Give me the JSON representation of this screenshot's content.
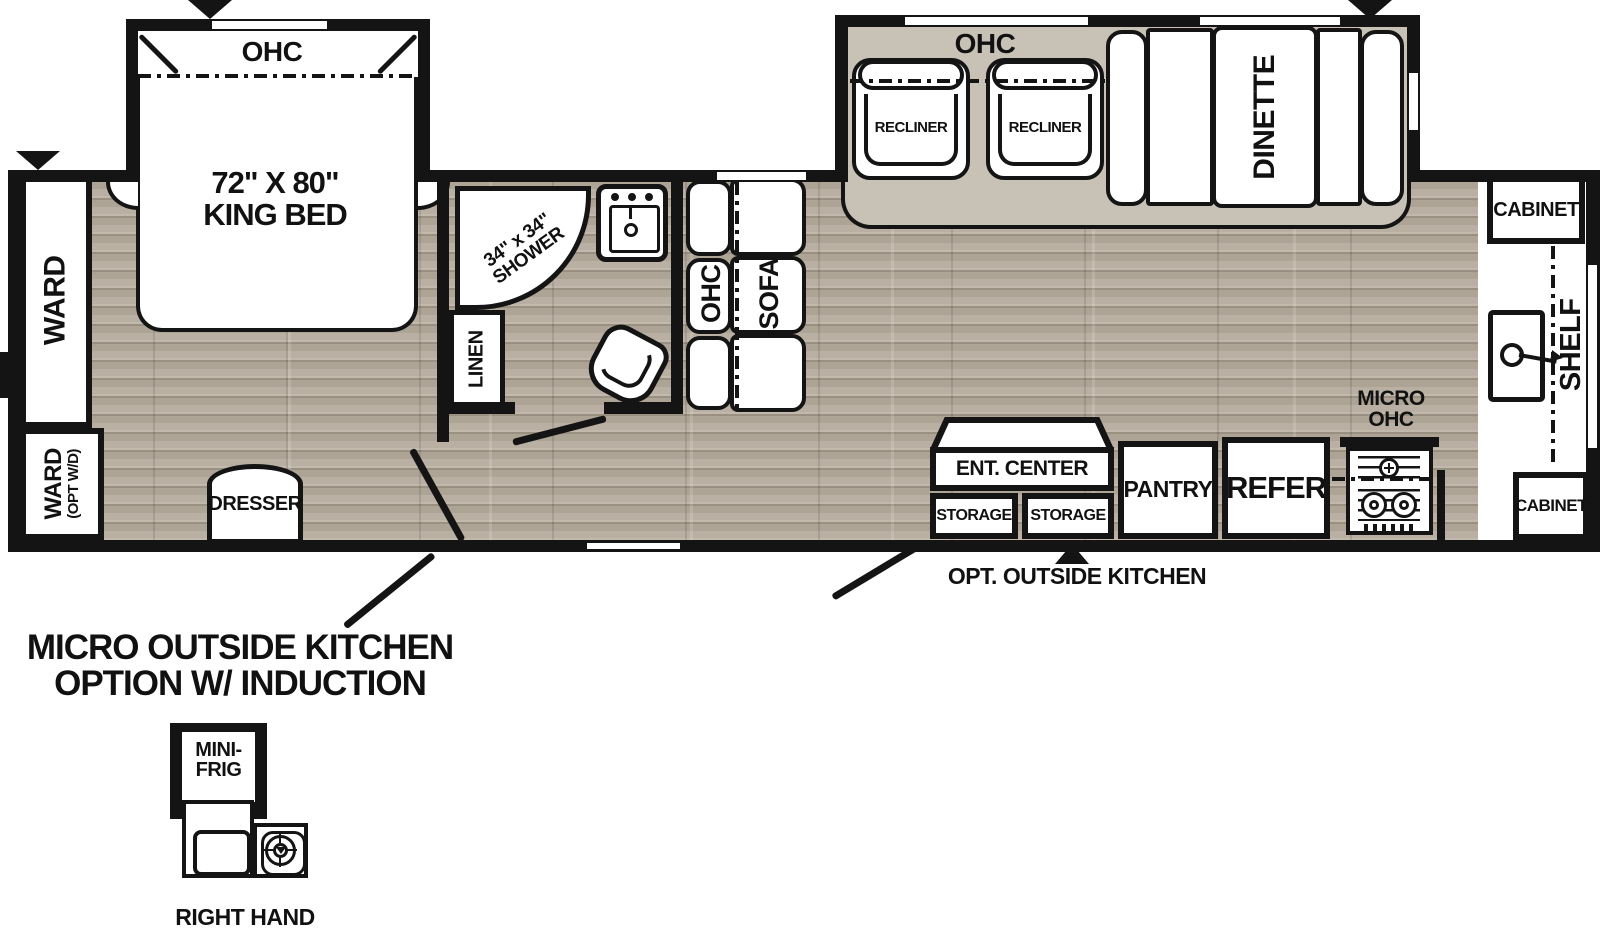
{
  "colors": {
    "wall": "#141414",
    "wood_floor": "#b5ac9f",
    "slide_floor": "#c8c1b6"
  },
  "bedroom": {
    "slide_ohc": "OHC",
    "bed_line1": "72\" X 80\"",
    "bed_line2": "KING BED",
    "ward": "WARD",
    "ward_wd_line1": "WARD",
    "ward_wd_line2": "(OPT W/D)",
    "dresser": "DRESSER"
  },
  "bathroom": {
    "shower_line1": "34\" x 34\"",
    "shower_line2": "SHOWER",
    "linen": "LINEN"
  },
  "living": {
    "sofa_ohc": "OHC",
    "sofa": "SOFA",
    "slide_ohc": "OHC",
    "recliner_left": "RECLINER",
    "recliner_right": "RECLINER",
    "dinette": "DINETTE"
  },
  "kitchen": {
    "ent_center": "ENT. CENTER",
    "storage_left": "STORAGE",
    "storage_right": "STORAGE",
    "pantry": "PANTRY",
    "refer": "REFER",
    "micro_ohc_line1": "MICRO",
    "micro_ohc_line2": "OHC",
    "cabinet_rear_top": "CABINET",
    "cabinet_rear_bottom": "CABINET",
    "shelf": "SHELF"
  },
  "annotations": {
    "opt_outside_kitchen": "OPT. OUTSIDE KITCHEN",
    "option_title_line1": "MICRO OUTSIDE KITCHEN",
    "option_title_line2": "OPTION W/ INDUCTION",
    "mini_frig_line1": "MINI-",
    "mini_frig_line2": "FRIG",
    "variant": "RIGHT HAND"
  }
}
